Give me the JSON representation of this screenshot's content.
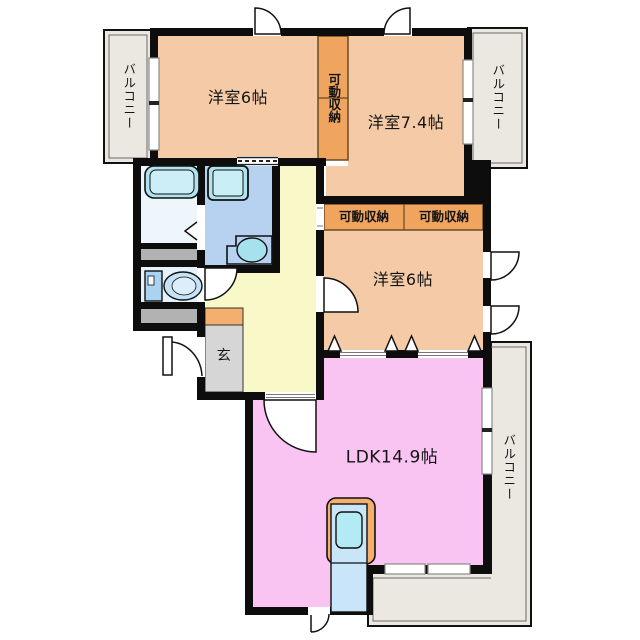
{
  "labels": {
    "bedroom1": "洋室6帖",
    "bedroom2": "洋室7.4帖",
    "bedroom3": "洋室6帖",
    "ldk": "LDK14.9帖",
    "entrance": "玄",
    "movable_storage_vertical": "可動収納",
    "movable_storage_left": "可動収納",
    "movable_storage_right": "可動収納",
    "balcony_left": "バルコニー",
    "balcony_top_right": "バルコニー",
    "balcony_right": "バルコニー"
  },
  "colors": {
    "wall": "#0d0d0d",
    "room_peach": "#f4cba6",
    "storage_orange": "#efa55d",
    "hallway_yellow": "#f8f8c8",
    "ldk_pink": "#f9c3f2",
    "balcony_gray": "#eae8e1",
    "entrance_gray": "#d6d6d6",
    "shoe_cabinet_orange": "#f4ae6d",
    "closet_gray": "#b2b2b2",
    "bathroom_blue": "#b7d2f0",
    "toilet_room_blue": "#e6f1fa",
    "washroom_blue": "#eef6fc",
    "fixture_cyan": "#aee3ef",
    "kitchen_counter_blue": "#c9e5f8",
    "sink_cyan": "#b2ebf3"
  }
}
